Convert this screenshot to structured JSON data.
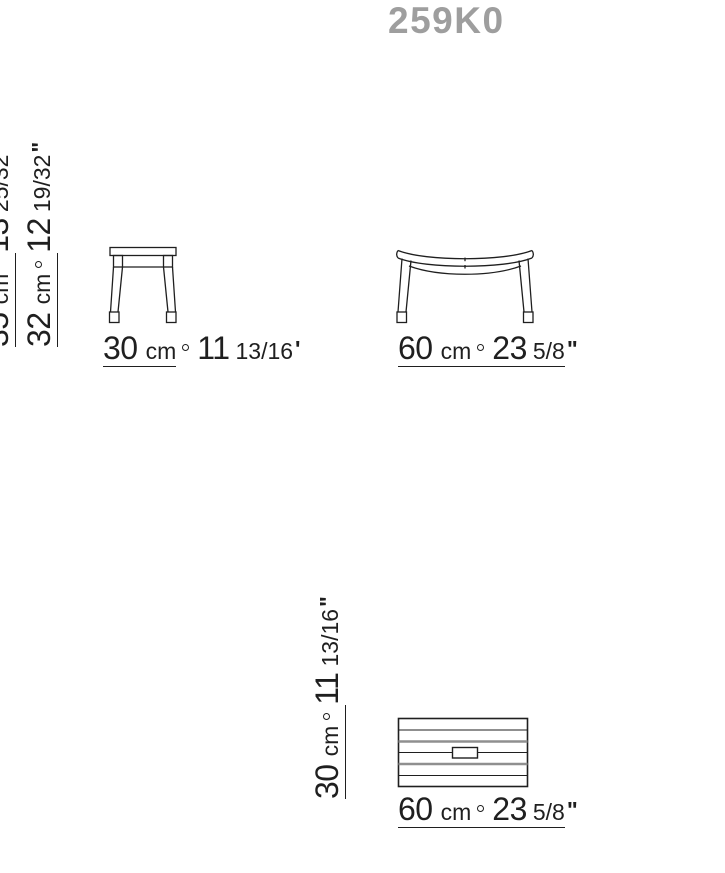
{
  "title": "259K0",
  "separator_icon": "ring-degree-separator",
  "colors": {
    "line": "#1f1f1f",
    "gray_line": "#8f8f8f",
    "title": "#9e9e9e"
  },
  "views": {
    "side": {
      "total_height": {
        "cm": "35",
        "unit": "cm",
        "inches": "13",
        "fraction": "25/32",
        "mark": "\""
      },
      "seat_height": {
        "cm": "32",
        "unit": "cm",
        "inches": "12",
        "fraction": "19/32",
        "mark": "\""
      },
      "width": {
        "cm": "30",
        "unit": "cm",
        "inches": "11",
        "fraction": "13/16",
        "mark": "'"
      }
    },
    "front": {
      "width": {
        "cm": "60",
        "unit": "cm",
        "inches": "23",
        "fraction": "5/8",
        "mark": "\""
      }
    },
    "top": {
      "depth": {
        "cm": "30",
        "unit": "cm",
        "inches": "11",
        "fraction": "13/16",
        "mark": "\""
      },
      "width": {
        "cm": "60",
        "unit": "cm",
        "inches": "23",
        "fraction": "5/8",
        "mark": "\""
      }
    }
  }
}
